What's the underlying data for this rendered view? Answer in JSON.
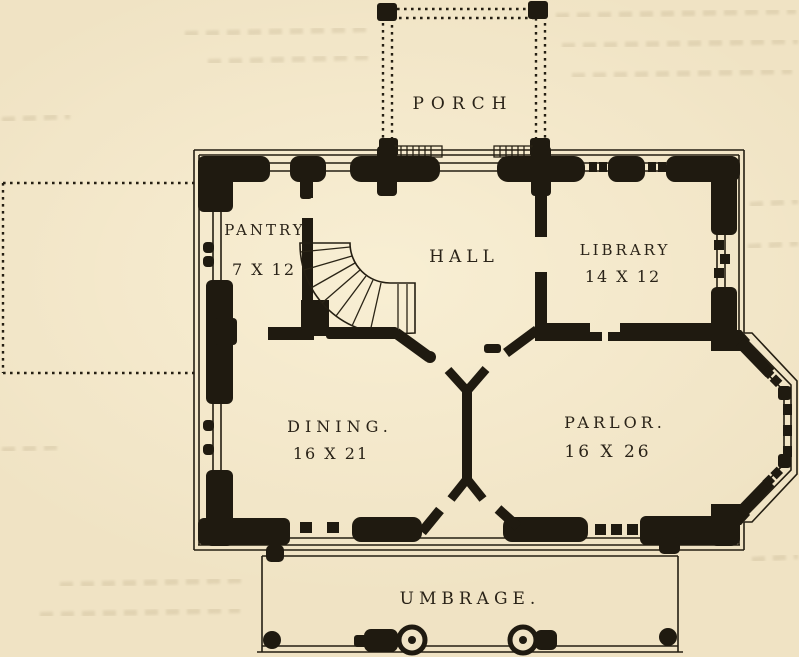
{
  "figure": {
    "kind": "house floor plan engraving",
    "paper_color": "#ecdfbe",
    "ink_color": "#1f1a10",
    "rooms": {
      "porch": {
        "label": "PORCH",
        "size": ""
      },
      "pantry": {
        "label": "PANTRY",
        "size": "7 X 12"
      },
      "hall": {
        "label": "HALL",
        "size": ""
      },
      "library": {
        "label": "LIBRARY",
        "size": "14 X 12"
      },
      "dining": {
        "label": "DINING.",
        "size": "16 X 21"
      },
      "parlor": {
        "label": "PARLOR.",
        "size": "16 X 26"
      },
      "umbrage": {
        "label": "UMBRAGE.",
        "size": ""
      }
    }
  }
}
